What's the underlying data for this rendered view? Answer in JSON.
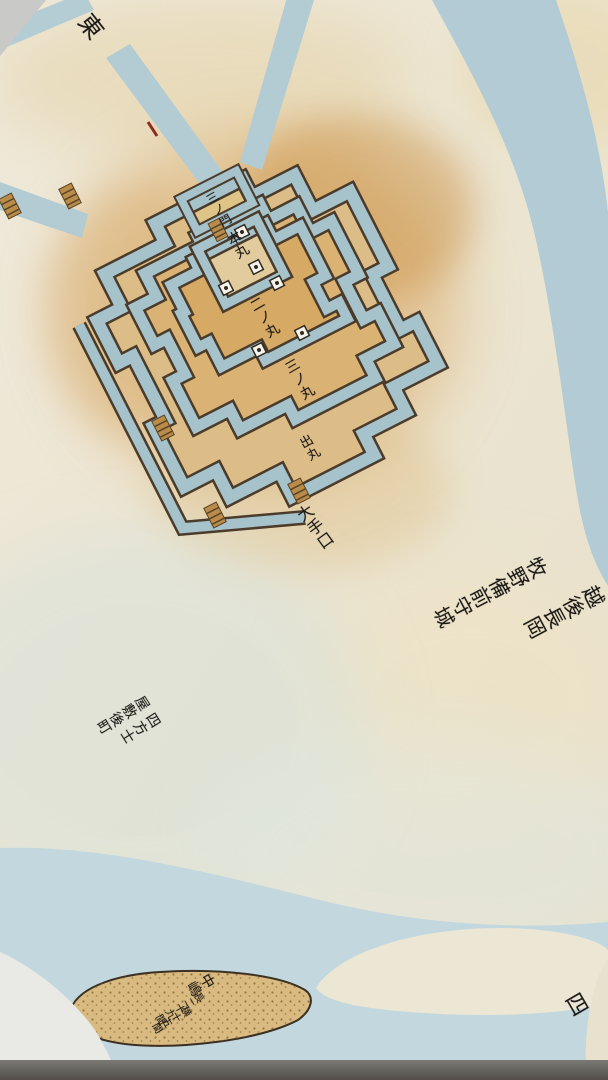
{
  "labels": {
    "corner_top_left": "東",
    "corner_bottom_right": "四",
    "castle": {
      "upper_gate": "三ノ門",
      "honmaru": "本丸",
      "ninomaru": "二ノ丸",
      "sannomaru": "三ノ丸",
      "demaru": "出丸",
      "oteguchi": "大手口"
    },
    "title": {
      "column1": "越後長岡",
      "column2": "牧野備前守城"
    },
    "residences": {
      "column1": "四方士",
      "column2": "屋敷後町"
    },
    "island": {
      "name": "中嶋",
      "length": "長二十九間",
      "width": "横十五間"
    }
  },
  "colors": {
    "paper": "#ece5d2",
    "stain_orange": "#d19b52",
    "water_moat": "#a6c2cb",
    "water_river": "#b9d2da",
    "ink": "#1c1a17",
    "island_sand": "#d9ba80",
    "gate_marker": "#f6f3ea",
    "bridge": "#b98c4a",
    "backing": "#c7c7c5",
    "frame_bar": "#5f5e59"
  }
}
